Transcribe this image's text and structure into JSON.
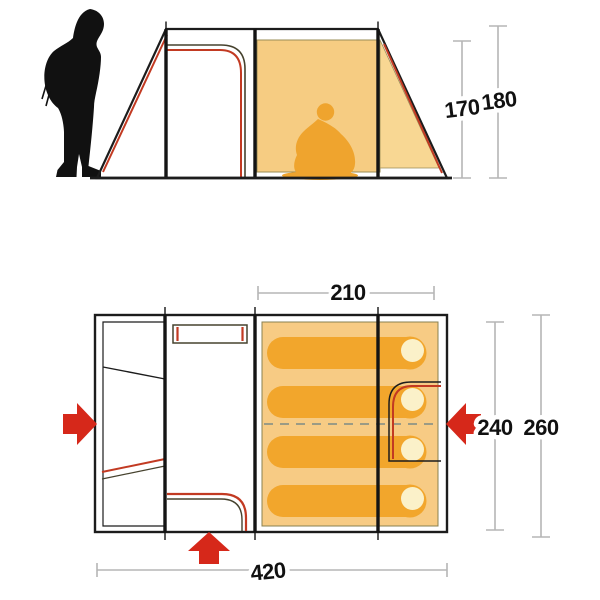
{
  "colors": {
    "canvas_cream": "#fbf1c9",
    "inner_tent_orange": "#f6cc82",
    "end_panel_orange": "#f8d793",
    "sleeping_area_orange": "#f7cb84",
    "sleeping_bag_orange": "#f2a62c",
    "pillow_cream": "#fbf1c9",
    "sitting_person_orange": "#efa42e",
    "silhouette_black": "#111111",
    "door_line_red": "#c23a22",
    "arrow_red": "#d6281a",
    "dimension_line_gray": "#b5b5b5",
    "outline_black": "#1c1c1c"
  },
  "side_view": {
    "inner_height_cm": "170",
    "outer_height_cm": "180"
  },
  "floor_plan": {
    "sleeping_area_width_cm": "210",
    "inner_depth_cm": "240",
    "outer_depth_cm": "260",
    "total_length_cm": "420"
  }
}
